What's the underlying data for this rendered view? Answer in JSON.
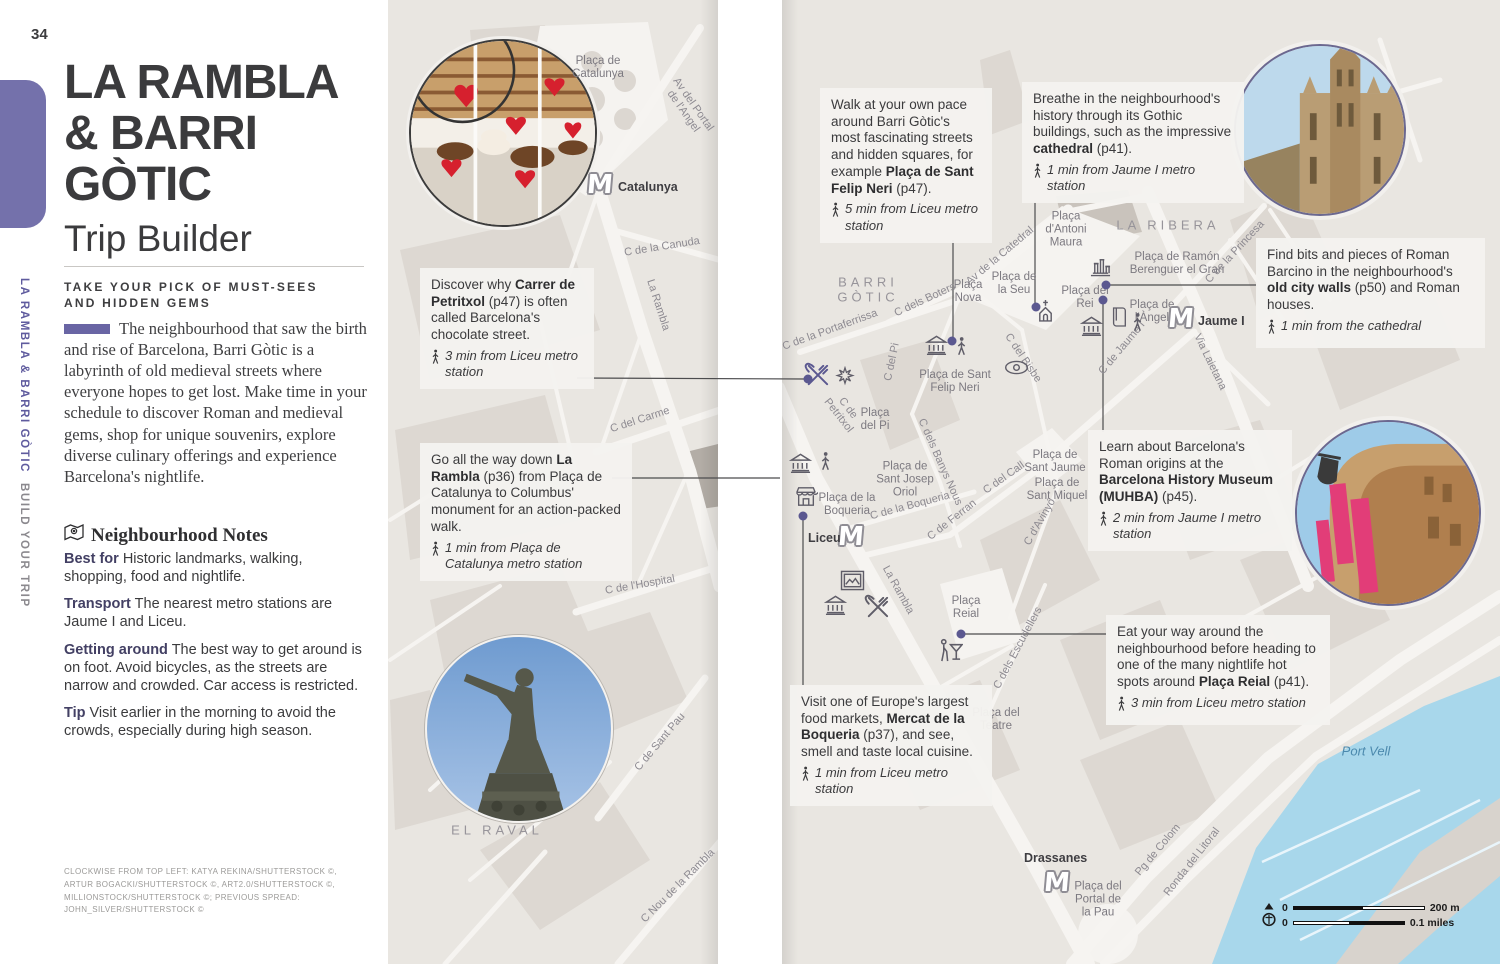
{
  "page": {
    "number": "34",
    "spine_title": "LA RAMBLA & BARRI GÒTIC",
    "spine_subtitle": "BUILD YOUR TRIP",
    "title_line1": "LA RAMBLA",
    "title_line2": "& BARRI",
    "title_line3": "GÒTIC",
    "subtitle": "Trip Builder",
    "tagline_line1": "TAKE YOUR PICK OF MUST-SEES",
    "tagline_line2": "AND HIDDEN GEMS",
    "intro": "The neighbourhood that saw the birth and rise of Barcelona, Barri Gòtic is a labyrinth of old medieval streets where everyone hopes to get lost. Make time in your schedule to discover Roman and medieval gems, shop for unique souvenirs, explore diverse culinary offerings and experience Barcelona's nightlife.",
    "notes_heading": "Neighbourhood Notes",
    "notes": [
      {
        "label": "Best for",
        "text": " Historic landmarks, walking, shopping, food and nightlife."
      },
      {
        "label": "Transport",
        "text": " The nearest metro stations are Jaume I and Liceu."
      },
      {
        "label": "Getting around",
        "text": " The best way to get around is on foot. Avoid bicycles, as the streets are narrow and crowded. Car access is restricted."
      },
      {
        "label": "Tip",
        "text": " Visit earlier in the morning to avoid the crowds, especially during high season."
      }
    ],
    "credits": "Clockwise from top left: Katya Rekina/Shutterstock ©, Artur Bogacki/Shutterstock ©, Art2.0/Shutterstock ©, Millionstock/Shutterstock ©; previous spread: John_Silver/Shutterstock ©"
  },
  "callouts": [
    {
      "name": "callout-carrer-petritxol",
      "x": 420,
      "y": 268,
      "w": 152,
      "segs": [
        {
          "t": "Discover why "
        },
        {
          "t": "Carrer de Petritxol",
          "b": true
        },
        {
          "t": " (p47) is often called Barcelona's chocolate street."
        }
      ],
      "note": "3 min from Liceu metro station"
    },
    {
      "name": "callout-la-rambla",
      "x": 420,
      "y": 443,
      "w": 190,
      "segs": [
        {
          "t": "Go all the way down "
        },
        {
          "t": "La Rambla",
          "b": true
        },
        {
          "t": " (p36) from Plaça de Catalunya to Columbus' monument for an action-packed walk."
        }
      ],
      "note": "1 min from Plaça de Catalunya metro station"
    },
    {
      "name": "callout-felip-neri",
      "x": 820,
      "y": 88,
      "w": 150,
      "segs": [
        {
          "t": "Walk at your own pace around Barri Gòtic's most fascinating streets and hidden squares, for example "
        },
        {
          "t": "Plaça de Sant Felip Neri",
          "b": true
        },
        {
          "t": " (p47)."
        }
      ],
      "note": "5 min from Liceu metro station"
    },
    {
      "name": "callout-cathedral",
      "x": 1022,
      "y": 82,
      "w": 200,
      "segs": [
        {
          "t": "Breathe in the neighbourhood's history through its Gothic buildings, such as the impressive "
        },
        {
          "t": "cathedral",
          "b": true
        },
        {
          "t": " (p41)."
        }
      ],
      "note": "1 min from Jaume I metro station"
    },
    {
      "name": "callout-old-city-walls",
      "x": 1256,
      "y": 238,
      "w": 207,
      "segs": [
        {
          "t": "Find bits and pieces of Roman Barcino in the neighbourhood's "
        },
        {
          "t": "old city walls",
          "b": true
        },
        {
          "t": " (p50) and Roman houses."
        }
      ],
      "note": "1 min from the cathedral"
    },
    {
      "name": "callout-muhba",
      "x": 1088,
      "y": 430,
      "w": 182,
      "segs": [
        {
          "t": "Learn about Barcelona's Roman origins at the "
        },
        {
          "t": "Barcelona History Museum (MUHBA)",
          "b": true
        },
        {
          "t": " (p45)."
        }
      ],
      "note": "2 min from Jaume I metro station"
    },
    {
      "name": "callout-placa-reial",
      "x": 1106,
      "y": 615,
      "w": 202,
      "segs": [
        {
          "t": "Eat your way around the neighbourhood before heading to one of the many nightlife hot spots around "
        },
        {
          "t": "Plaça Reial",
          "b": true
        },
        {
          "t": " (p41)."
        }
      ],
      "note": "3 min from Liceu metro station"
    },
    {
      "name": "callout-boqueria",
      "x": 790,
      "y": 685,
      "w": 180,
      "segs": [
        {
          "t": "Visit one of Europe's largest food markets, "
        },
        {
          "t": "Mercat de la Boqueria",
          "b": true
        },
        {
          "t": " (p37), and see, smell and taste local cuisine."
        }
      ],
      "note": "1 min from Liceu metro station"
    }
  ],
  "map": {
    "labels": [
      {
        "t": "Plaça de\nCatalunya",
        "x": 598,
        "y": 68,
        "cls": "place"
      },
      {
        "t": "Av del Portal\nde l'Angel",
        "x": 688,
        "y": 108,
        "rot": 55,
        "cls": "street"
      },
      {
        "t": "C de la Canuda",
        "x": 662,
        "y": 247,
        "rot": -9,
        "cls": "street"
      },
      {
        "t": "La Rambla",
        "x": 658,
        "y": 305,
        "rot": 72,
        "cls": "street"
      },
      {
        "t": "C del Carme",
        "x": 640,
        "y": 420,
        "rot": -18,
        "cls": "street"
      },
      {
        "t": "C de l'Hospital",
        "x": 640,
        "y": 585,
        "rot": -10,
        "cls": "street"
      },
      {
        "t": "C de Sant Pau",
        "x": 660,
        "y": 742,
        "rot": -50,
        "cls": "street"
      },
      {
        "t": "EL RAVAL",
        "x": 497,
        "y": 831,
        "cls": "district"
      },
      {
        "t": "C Nou de la Rambla",
        "x": 678,
        "y": 886,
        "rot": -45,
        "cls": "street"
      },
      {
        "t": "BARRI\nGÒTIC",
        "x": 868,
        "y": 290,
        "cls": "district"
      },
      {
        "t": "C dels Boters",
        "x": 925,
        "y": 300,
        "rot": -25,
        "cls": "street"
      },
      {
        "t": "Plaça\nNova",
        "x": 968,
        "y": 292,
        "cls": "place"
      },
      {
        "t": "Av de la Catedral",
        "x": 1000,
        "y": 256,
        "rot": -40,
        "cls": "street"
      },
      {
        "t": "Plaça de\nla Seu",
        "x": 1014,
        "y": 284,
        "cls": "place"
      },
      {
        "t": "Plaça\nd'Antoni\nMaura",
        "x": 1066,
        "y": 230,
        "cls": "place"
      },
      {
        "t": "LA RIBERA",
        "x": 1168,
        "y": 226,
        "cls": "district"
      },
      {
        "t": "Plaça de Ramón\nBerenguer el Gran",
        "x": 1177,
        "y": 264,
        "cls": "place"
      },
      {
        "t": "C de la Princesa",
        "x": 1235,
        "y": 252,
        "rot": -47,
        "cls": "street"
      },
      {
        "t": "Plaça del\nRei",
        "x": 1085,
        "y": 298,
        "cls": "place"
      },
      {
        "t": "Plaça de\nl'Àngel",
        "x": 1152,
        "y": 312,
        "cls": "place"
      },
      {
        "t": "Via Laietana",
        "x": 1210,
        "y": 362,
        "rot": 64,
        "cls": "street"
      },
      {
        "t": "C de Jaume I",
        "x": 1122,
        "y": 348,
        "rot": -50,
        "cls": "street"
      },
      {
        "t": "C de la Portaferrissa",
        "x": 830,
        "y": 330,
        "rot": -20,
        "cls": "street"
      },
      {
        "t": "C del Pi",
        "x": 892,
        "y": 362,
        "rot": -78,
        "cls": "street"
      },
      {
        "t": "C de\nPetritxol",
        "x": 843,
        "y": 412,
        "rot": 52,
        "cls": "street"
      },
      {
        "t": "Plaça\ndel Pi",
        "x": 875,
        "y": 420,
        "cls": "place"
      },
      {
        "t": "Plaça de Sant\nFelip Neri",
        "x": 955,
        "y": 382,
        "cls": "place"
      },
      {
        "t": "C del Bisbe",
        "x": 1023,
        "y": 358,
        "rot": 56,
        "cls": "street"
      },
      {
        "t": "Plaça de\nSant Jaume",
        "x": 1055,
        "y": 462,
        "cls": "place"
      },
      {
        "t": "C del Call",
        "x": 1004,
        "y": 478,
        "rot": -35,
        "cls": "street"
      },
      {
        "t": "C dels Banys Nous",
        "x": 940,
        "y": 462,
        "rot": 66,
        "cls": "street"
      },
      {
        "t": "Plaça de\nSant Josep\nOriol",
        "x": 905,
        "y": 480,
        "cls": "place"
      },
      {
        "t": "Plaça de\nSant Miquel",
        "x": 1057,
        "y": 490,
        "cls": "place"
      },
      {
        "t": "C d'Avinyó",
        "x": 1040,
        "y": 522,
        "rot": -60,
        "cls": "street"
      },
      {
        "t": "C de Ferran",
        "x": 952,
        "y": 520,
        "rot": -38,
        "cls": "street"
      },
      {
        "t": "C de la Boqueria",
        "x": 910,
        "y": 506,
        "rot": -15,
        "cls": "street"
      },
      {
        "t": "Plaça de la\nBoqueria",
        "x": 847,
        "y": 505,
        "cls": "place"
      },
      {
        "t": "La Rambla",
        "x": 898,
        "y": 590,
        "rot": 61,
        "cls": "street"
      },
      {
        "t": "Plaça\nReial",
        "x": 966,
        "y": 608,
        "cls": "place"
      },
      {
        "t": "C dels Escudellers",
        "x": 1018,
        "y": 648,
        "rot": -62,
        "cls": "street"
      },
      {
        "t": "Plaça del\nTeatre",
        "x": 996,
        "y": 720,
        "cls": "place"
      },
      {
        "t": "Plaça del\nPortal de\nla Pau",
        "x": 1098,
        "y": 900,
        "cls": "place"
      },
      {
        "t": "Pg de Colom",
        "x": 1158,
        "y": 850,
        "rot": -50,
        "cls": "street"
      },
      {
        "t": "Ronda del Litoral",
        "x": 1192,
        "y": 862,
        "rot": -52,
        "cls": "street"
      },
      {
        "t": "Port Vell",
        "x": 1366,
        "y": 752,
        "cls": "water"
      }
    ],
    "metro_stations": [
      {
        "label": "Catalunya",
        "mx": 587,
        "my": 172,
        "lx": 618,
        "ly": 180
      },
      {
        "label": "Jaume I",
        "mx": 1168,
        "my": 306,
        "lx": 1198,
        "ly": 314
      },
      {
        "label": "Liceu",
        "mx": 838,
        "my": 524,
        "lx": 808,
        "ly": 531
      },
      {
        "label": "Drassanes",
        "mx": 1044,
        "my": 870,
        "lx": 1024,
        "ly": 851
      }
    ],
    "icons": [
      {
        "k": "museum",
        "x": 925,
        "y": 334
      },
      {
        "k": "walker",
        "x": 956,
        "y": 336
      },
      {
        "k": "church",
        "x": 1036,
        "y": 299
      },
      {
        "k": "columns",
        "x": 1088,
        "y": 256
      },
      {
        "k": "book",
        "x": 1110,
        "y": 306
      },
      {
        "k": "walker",
        "x": 1132,
        "y": 312
      },
      {
        "k": "museum",
        "x": 1080,
        "y": 315
      },
      {
        "k": "eye",
        "x": 1004,
        "y": 360
      },
      {
        "k": "utensils",
        "x": 802,
        "y": 362,
        "purple": true
      },
      {
        "k": "burst",
        "x": 834,
        "y": 366
      },
      {
        "k": "museum",
        "x": 789,
        "y": 452
      },
      {
        "k": "walker",
        "x": 820,
        "y": 451
      },
      {
        "k": "market",
        "x": 794,
        "y": 485
      },
      {
        "k": "frame",
        "x": 840,
        "y": 570
      },
      {
        "k": "museum",
        "x": 824,
        "y": 594
      },
      {
        "k": "utensils",
        "x": 862,
        "y": 594
      },
      {
        "k": "cocktail",
        "x": 938,
        "y": 636
      }
    ],
    "dots": [
      [
        952,
        341
      ],
      [
        1036,
        307
      ],
      [
        1106,
        285
      ],
      [
        1103,
        300
      ],
      [
        961,
        634
      ],
      [
        803,
        516
      ],
      [
        808,
        379
      ]
    ],
    "leaders": [
      [
        577,
        378,
        806,
        379
      ],
      [
        612,
        478,
        780,
        478
      ],
      [
        953,
        240,
        953,
        341
      ],
      [
        1035,
        202,
        1035,
        307
      ],
      [
        1106,
        285,
        1256,
        285
      ],
      [
        1103,
        300,
        1103,
        432
      ],
      [
        1106,
        634,
        961,
        634
      ],
      [
        803,
        516,
        803,
        685
      ]
    ]
  },
  "scalebar": {
    "zero_top": "0",
    "zero_bottom": "0",
    "top_label": "200 m",
    "bottom_label": "0.1 miles"
  }
}
